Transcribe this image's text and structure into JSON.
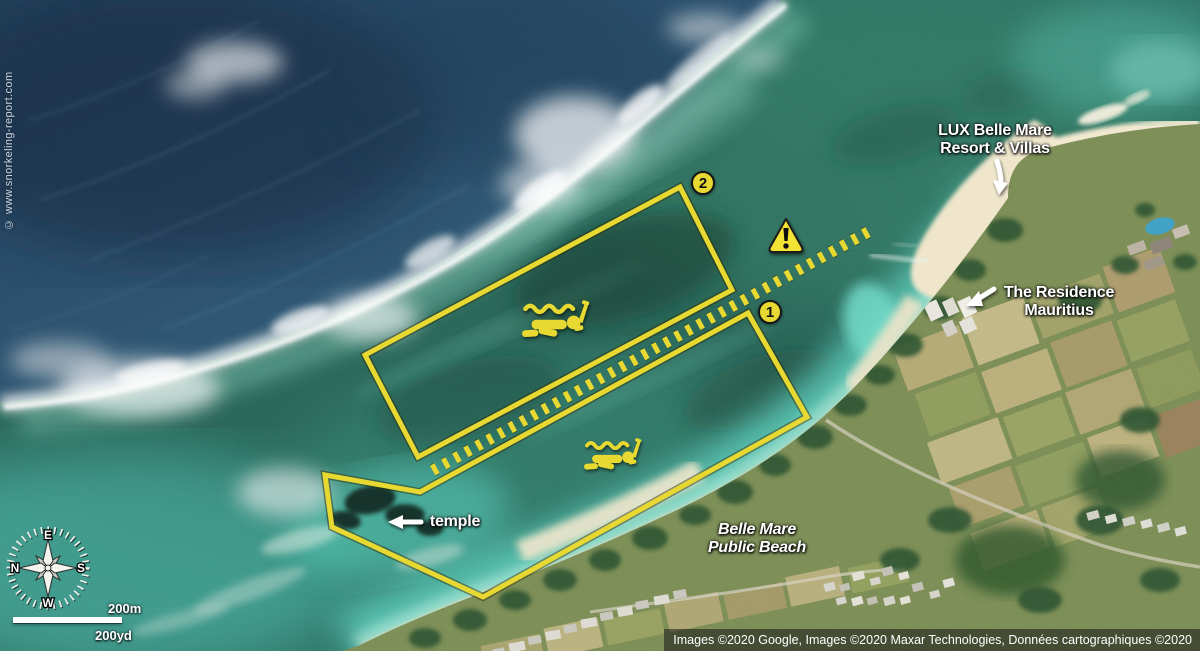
{
  "watermark": "© www.snorkeling-report.com",
  "zones": {
    "zone1_badge": "1",
    "zone2_badge": "2"
  },
  "labels": {
    "lux_resort": {
      "line1": "LUX Belle Mare",
      "line2": "Resort & Villas"
    },
    "residence": {
      "line1": "The Residence",
      "line2": "Mauritius"
    },
    "temple": "temple",
    "public_beach": {
      "line1": "Belle Mare",
      "line2": "Public Beach"
    }
  },
  "icons": {
    "snorkeler": "snorkeler-icon",
    "warning": "warning-triangle-icon",
    "compass": "compass-rose-icon"
  },
  "compass": {
    "north": "N",
    "east": "E",
    "south": "S",
    "west": "W"
  },
  "scale_bar": {
    "metric": "200m",
    "imperial": "200yd"
  },
  "attribution": "Images ©2020 Google, Images ©2020 Maxar Technologies, Données cartographiques ©2020",
  "colors": {
    "route_yellow": "#e7d832",
    "deep_ocean": "#2a4a63",
    "lagoon_green": "#2f7265",
    "shallow_turquoise": "#5fd0bd",
    "sand": "#ecdfc0",
    "label_white": "#ffffff"
  }
}
